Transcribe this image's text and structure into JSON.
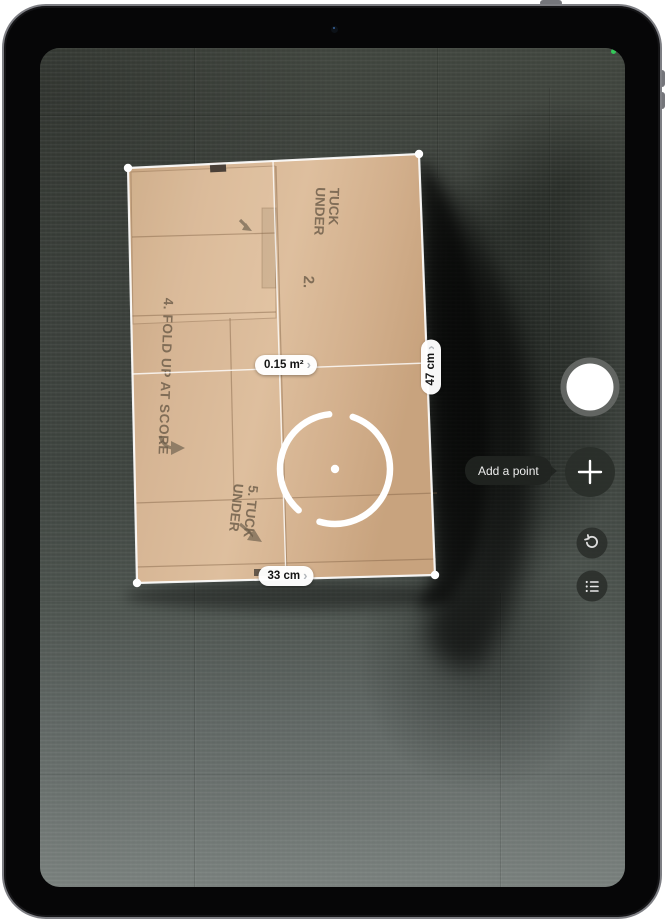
{
  "app": {
    "name": "Measure AR camera view"
  },
  "measurements": {
    "area": "0.15 m²",
    "right_side": "47 cm",
    "bottom_side": "33 cm",
    "detail_chevron": "›"
  },
  "tooltip": {
    "add_point": "Add a point"
  },
  "box_print": {
    "step_two": "2.",
    "tuck_top_line1": "TUCK",
    "tuck_top_line2": "UNDER",
    "fold_up": "4. FOLD UP AT SCORE",
    "tuck_bottom_line1": "5. TUCK",
    "tuck_bottom_line2": "UNDER"
  },
  "icons": {
    "shutter": "shutter-circle",
    "add_point": "plus-icon",
    "undo": "undo-arrow-icon",
    "list": "list-bullet-icon"
  },
  "colors": {
    "camera_indicator_green": "#34c759",
    "measure_line": "#ffffff",
    "pill_background": "#ffffff",
    "cardboard": "#d6b594"
  }
}
